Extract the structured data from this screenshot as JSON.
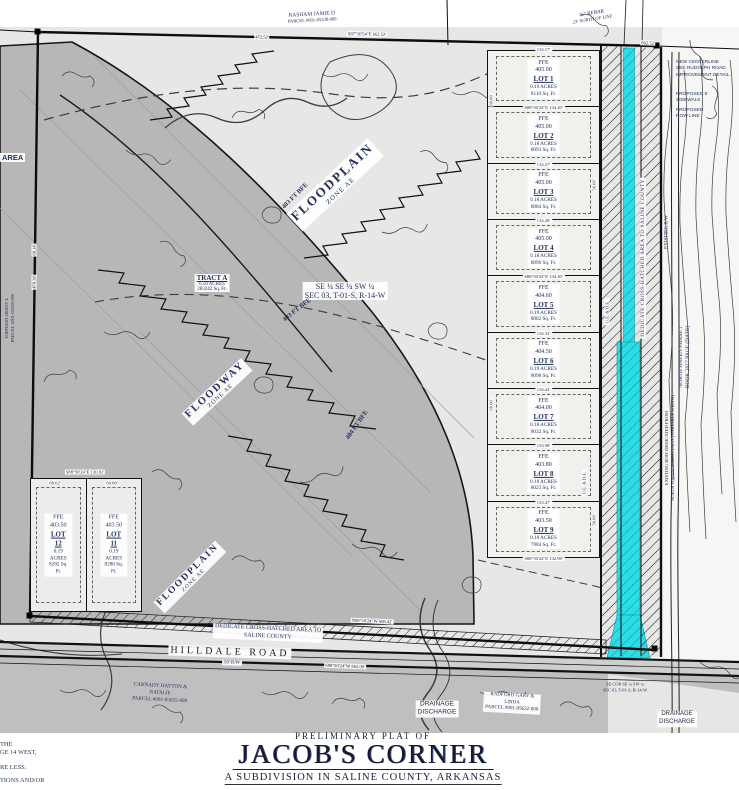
{
  "colors": {
    "ink": "#23335c",
    "highlight": "#2bdde6",
    "floodway": "#b7b7b7",
    "floodplain": "#e7e7e7",
    "lotbg": "#eff1ed",
    "roadgray": "#cfcfcf",
    "bottomgray": "#bfbfbf"
  },
  "title_block": {
    "pre": "PRELIMINARY PLAT OF",
    "name": "JACOB'S CORNER",
    "sub": "A SUBDIVISION IN SALINE COUNTY, ARKANSAS"
  },
  "labels": {
    "ffe": "FFE"
  },
  "areas": {
    "floodplain_top": {
      "name": "FLOODPLAIN",
      "zone": "ZONE AE"
    },
    "floodplain_bottom": {
      "name": "FLOODPLAIN",
      "zone": "ZONE AE"
    },
    "floodway": {
      "name": "FLOODWAY",
      "zone": "ZONE AE"
    }
  },
  "tract": {
    "name": "TRACT A",
    "acres": "6.50 ACRES",
    "sqft": "283242 Sq. Ft."
  },
  "section_label": {
    "line1": "SE ¼ SE ¼ SW ¼",
    "line2": "SEC 03, T-01-S, R-14-W"
  },
  "bfe": {
    "a": "403 FT BFE",
    "b": "403 FT BFE",
    "c": "404 FT BFE"
  },
  "lots": [
    {
      "id": "LOT 1",
      "elev": "405.00",
      "acres": "0.19 ACRES",
      "sqft": "8110 Sq. Ft.",
      "top": "134.17'",
      "bottom": "S88°50'24\"E  134.20'"
    },
    {
      "id": "LOT 2",
      "elev": "405.00",
      "acres": "0.18 ACRES",
      "sqft": "8093 Sq. Ft.",
      "bottom": "134.27'"
    },
    {
      "id": "LOT 3",
      "elev": "405.00",
      "acres": "0.18 ACRES",
      "sqft": "8084 Sq. Ft.",
      "bottom": "134.28'"
    },
    {
      "id": "LOT 4",
      "elev": "405.00",
      "acres": "0.18 ACRES",
      "sqft": "8096 Sq. Ft.",
      "bottom": "S88°50'24\"E  134.30'"
    },
    {
      "id": "LOT 5",
      "elev": "404.60",
      "acres": "0.19 ACRES",
      "sqft": "8082 Sq. Ft.",
      "bottom": "134.32'"
    },
    {
      "id": "LOT 6",
      "elev": "404.50",
      "acres": "0.19 ACRES",
      "sqft": "8098 Sq. Ft.",
      "bottom": "134.42'"
    },
    {
      "id": "LOT 7",
      "elev": "404.00",
      "acres": "0.18 ACRES",
      "sqft": "8032 Sq. Ft.",
      "bottom": "133.98'"
    },
    {
      "id": "LOT 8",
      "elev": "403.80",
      "acres": "0.18 ACRES",
      "sqft": "8023 Sq. Ft.",
      "bottom": "133.47'"
    },
    {
      "id": "LOT 9",
      "elev": "403.50",
      "acres": "0.18 ACRES",
      "sqft": "7984 Sq. Ft.",
      "bottom": "S88°50'24\"E  132.98'"
    }
  ],
  "west_lots": [
    {
      "id": "LOT 12",
      "elev": "403.50",
      "acres": "0.19 ACRES",
      "sqft": "8282 Sq. Ft."
    },
    {
      "id": "LOT 11",
      "elev": "403.50",
      "acres": "0.19 ACRES",
      "sqft": "8280 Sq. Ft."
    }
  ],
  "dims": {
    "top_left": "472.52'",
    "top_mid": "S87°30'54\"E  662.52'",
    "top_right": "662.52'",
    "bottom_outer": "N88°50'24\"W  608.42'",
    "bottom_road": "S88°50'24\"W  662.08'",
    "left_a": "68.18'",
    "left_b": "478.30'",
    "west_top": "S88°50'24\"E  120.02'",
    "lot12_top": "60.02'",
    "lot11_top": "60.00'",
    "strip": "50.00'",
    "lot_side": "60.00'"
  },
  "annotations": {
    "rasham": {
      "l1": "RASHAM JAMIE D",
      "l2": "PARCEL #001-05338-000"
    },
    "rebar": {
      "l1": "⅝\" REBAR",
      "l2": "23' NORTH OF LINE"
    },
    "new_centerline": {
      "l1": "NEW CENTERLINE",
      "l2": "SEE RUDOLPH ROAD",
      "l3": "IMPROVEMENT DETAIL"
    },
    "sidewalk": {
      "l1": "PROPOSED 5'",
      "l2": "SIDEWALK"
    },
    "row_line": {
      "l1": "PROPOSED",
      "l2": "ROW LINE"
    },
    "north_haven": {
      "l1": "NORTH HAVEN PHASE 1",
      "l2": "BOOK 2017 PAGE (DATE)"
    },
    "existing_row": {
      "l1": "EXISTING ROW DEDICATED FROM",
      "l2": "NORTH HAVEN SUBDIVISION (VARIABLE WIDTH)"
    },
    "existing_rw": "EXISTING R/W",
    "dedicate_vertical": "DEDICATE CROSS-HATCHED AREA TO SALINE COUNTY",
    "dedicate_horizontal": {
      "l1": "DEDICATE CROSS-HATCHED AREA TO",
      "l2": "SALINE COUNTY"
    },
    "ue_de": "U.E. & D.E.",
    "hilldale": "HILLDALE ROAD",
    "rw50": "50' R/W",
    "cannady": {
      "l1": "CANNADY DAYTON &",
      "l2": "NATALIE",
      "l3": "PARCEL #001-05655-000"
    },
    "drainage": {
      "l1": "DRAINAGE",
      "l2": "DISCHARGE"
    },
    "radford": {
      "l1": "RADFORD GARY &",
      "l2": "LINDA",
      "l3": "PARCEL #001-05632-000"
    },
    "se_cor": {
      "l1": "SE COR SE ¼ SW ¼",
      "l2": "SEC 03, T-01-S, R-14-W"
    },
    "johnson": {
      "l1": "JOHNSON JIMMY L",
      "l2": "PARCEL #001-05550-000"
    },
    "area_fragment": "AREA"
  },
  "edge_fragments": [
    "THE",
    "GE 14 WEST,",
    "RE LESS.",
    "TIONS AND/OR"
  ]
}
